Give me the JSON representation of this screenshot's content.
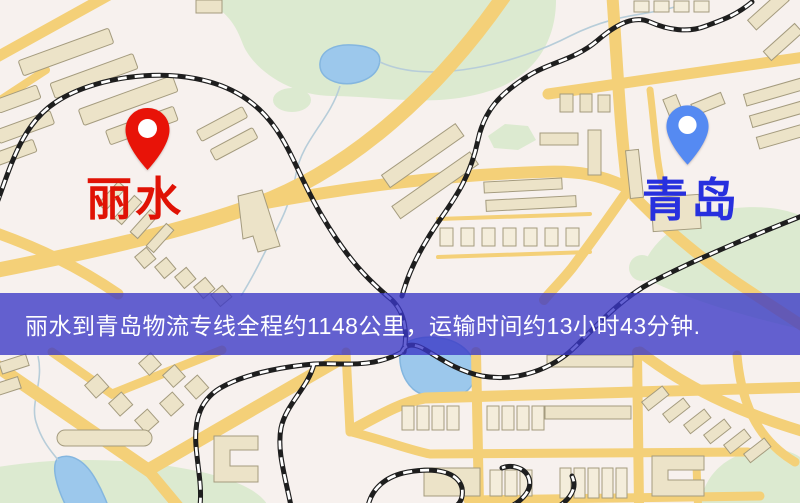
{
  "banner": {
    "text": "丽水到青岛物流专线全程约1148公里，运输时间约13小时43分钟.",
    "background_color": "#3a37c6",
    "text_color": "#ffffff"
  },
  "map": {
    "origin": {
      "label": "丽水",
      "pin_icon": "location-pin",
      "pin_color": "#e81308",
      "label_color": "#e01205"
    },
    "destination": {
      "label": "青岛",
      "pin_icon": "location-pin",
      "pin_color": "#558af2",
      "label_color": "#2730de"
    },
    "colors": {
      "background": "#f7f1ee",
      "road": "#f4d078",
      "building": "#ece3c8",
      "building_outline": "#a49b7e",
      "park": "#dcead0",
      "water": "#9cc8ec",
      "railway": "#1e1e1e"
    }
  }
}
